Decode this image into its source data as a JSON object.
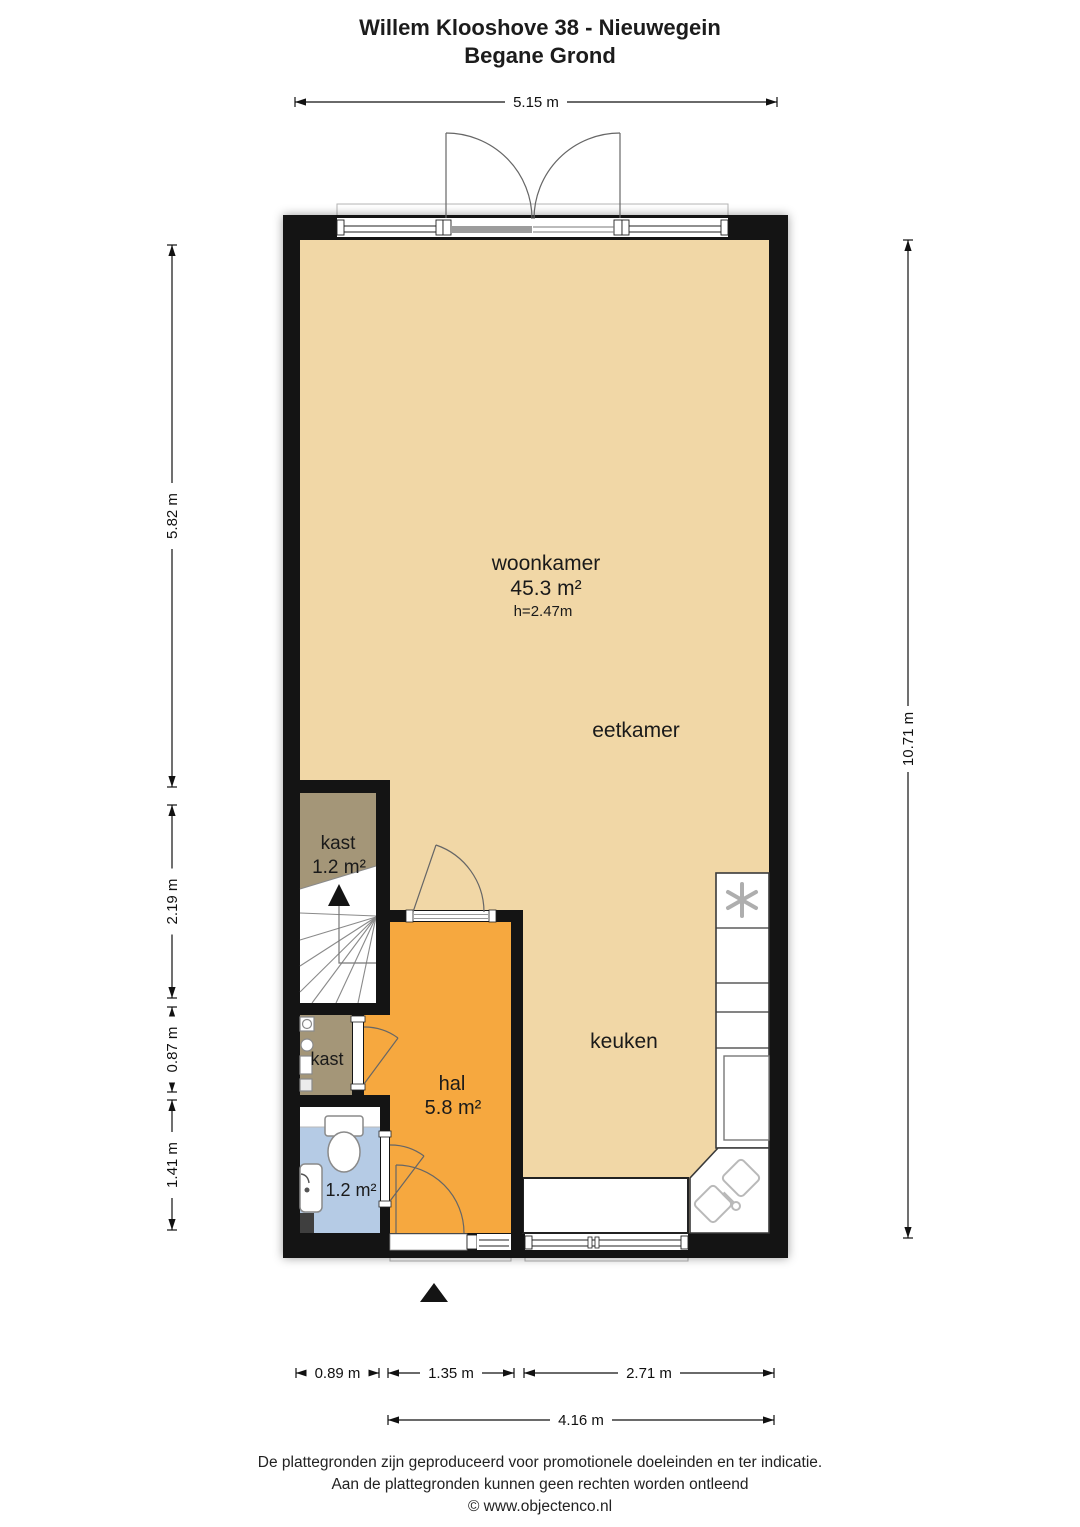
{
  "header": {
    "title": "Willem Klooshove 38 - Nieuwegein",
    "subtitle": "Begane Grond"
  },
  "floorplan": {
    "rooms": {
      "woonkamer": {
        "name": "woonkamer",
        "area": "45.3 m²",
        "ceiling_height": "h=2.47m"
      },
      "eetkamer": {
        "name": "eetkamer"
      },
      "keuken": {
        "name": "keuken"
      },
      "kast_boven": {
        "name": "kast",
        "area": "1.2 m²"
      },
      "kast_onder": {
        "name": "kast"
      },
      "hal": {
        "name": "hal",
        "area": "5.8 m²"
      },
      "toilet": {
        "area": "1.2 m²"
      }
    },
    "colors": {
      "wall": "#141414",
      "floor": "#f1d7a6",
      "hal": "#f6a83f",
      "kast": "#a49678",
      "toilet": "#b5cbe5"
    }
  },
  "dimensions": {
    "top": "5.15 m",
    "left_upper": "5.82 m",
    "left_mid": "2.19 m",
    "left_lower": "0.87 m",
    "left_bottom": "1.41 m",
    "right": "10.71 m",
    "bottom_left": "0.89 m",
    "bottom_mid": "1.35 m",
    "bottom_right": "2.71 m",
    "bottom_total": "4.16 m"
  },
  "footer": {
    "line1": "De plattegronden zijn geproduceerd voor promotionele doeleinden en ter indicatie.",
    "line2": "Aan de plattegronden kunnen geen rechten worden ontleend",
    "line3": "© www.objectenco.nl"
  }
}
